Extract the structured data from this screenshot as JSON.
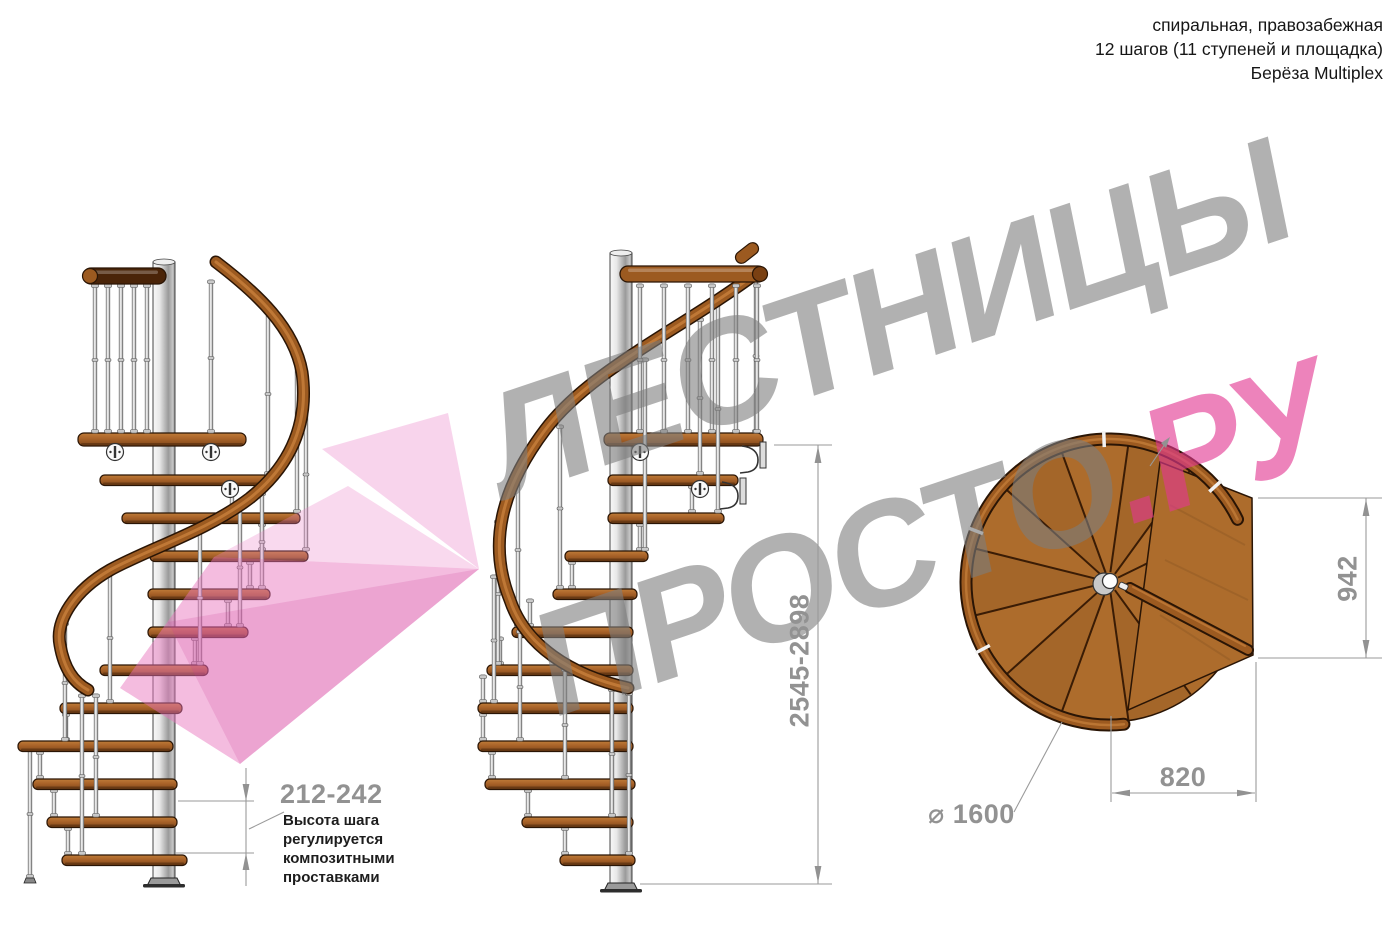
{
  "header": {
    "line1": "спиральная, правозабежная",
    "line2": "12 шагов (11 ступеней и площадка)",
    "line3": "Берёза Multiplex"
  },
  "watermark": {
    "word1": "ЛЕСТНИЦЫ",
    "word2": "ПРОСТО",
    "word2_suffix": ".РУ"
  },
  "annotations": {
    "step_height": {
      "value": "212-242",
      "note": "Высота шага регулируется композитными проставками"
    },
    "total_height": {
      "value": "2545-2898"
    },
    "landing_depth": {
      "value": "942"
    },
    "landing_width": {
      "value": "820"
    },
    "diameter": {
      "value": "⌀ 1600"
    }
  },
  "colors": {
    "wood_light": "#c07c38",
    "wood": "#ad6c2c",
    "wood_dark": "#7e471a",
    "wood_outline": "#2a1505",
    "rail": "#9c5a20",
    "rail_highlight": "#c8803c",
    "rail_dark_bar": "#4a2408",
    "metal_light": "#f8f8f8",
    "metal_dark": "#8f8f8f",
    "dimension_gray": "#929292",
    "watermark_gray": "#7d7d7d",
    "watermark_pink": "#e23791"
  }
}
